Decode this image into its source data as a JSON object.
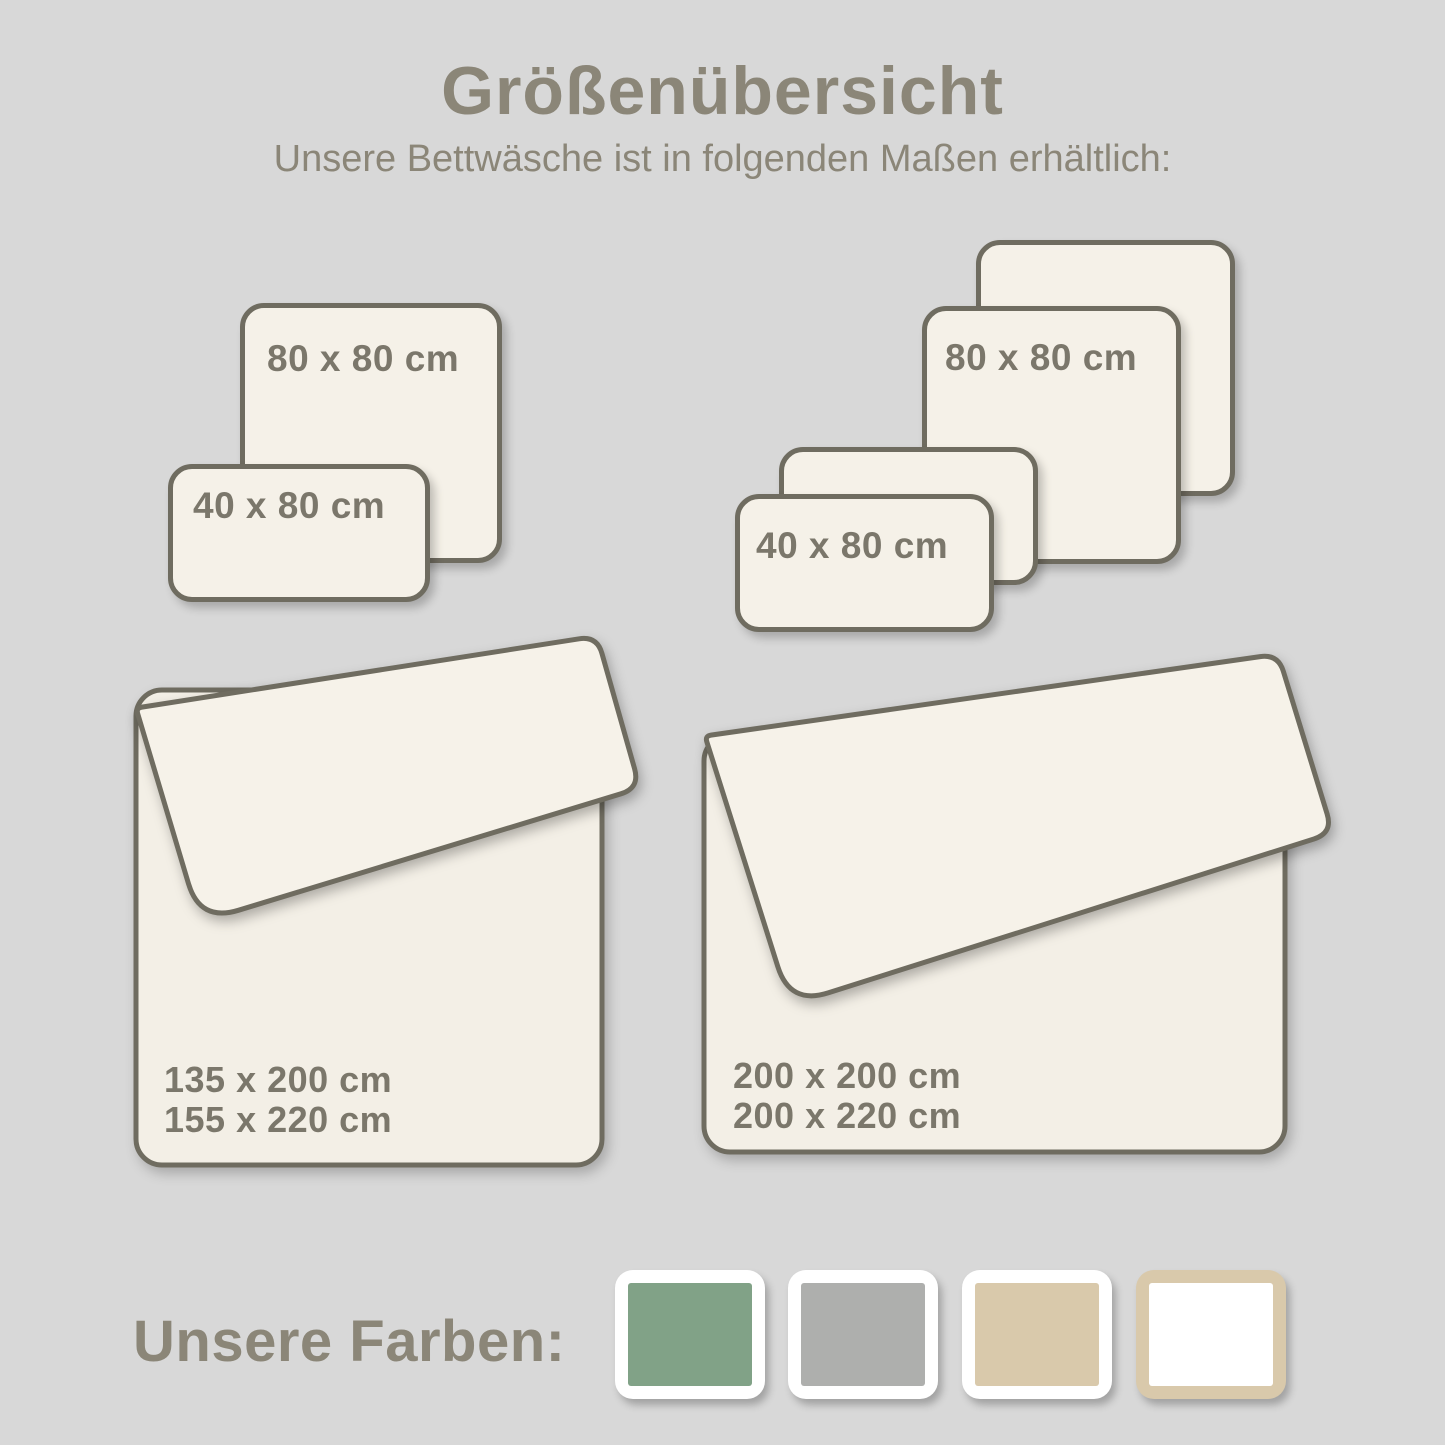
{
  "title": "Größenübersicht",
  "subtitle": "Unsere Bettwäsche ist in folgenden Maßen erhältlich:",
  "pillow_groups": {
    "left": {
      "square_label": "80 x 80 cm",
      "rect_label": "40 x 80 cm"
    },
    "right": {
      "square_label": "80 x 80 cm",
      "rect_label": "40 x 80 cm"
    }
  },
  "duvets": {
    "left": {
      "sizes": [
        "135 x 200 cm",
        "155 x 220 cm"
      ]
    },
    "right": {
      "sizes": [
        "200 x 200 cm",
        "200 x 220 cm"
      ]
    }
  },
  "colors_section": {
    "label": "Unsere Farben:",
    "swatches": [
      {
        "name": "green",
        "hex": "#81a287",
        "frame_hex": "#ffffff"
      },
      {
        "name": "gray",
        "hex": "#aeafad",
        "frame_hex": "#ffffff"
      },
      {
        "name": "beige",
        "hex": "#d9c9ab",
        "frame_hex": "#ffffff"
      },
      {
        "name": "white",
        "hex": "#ffffff",
        "frame_hex": "#d9c9ab"
      }
    ]
  },
  "palette": {
    "background": "#d8d8d8",
    "panel_fill": "#f5f1e8",
    "panel_stroke": "#6f6c60",
    "heading_text": "#8b8678",
    "label_text": "#7b776b"
  }
}
